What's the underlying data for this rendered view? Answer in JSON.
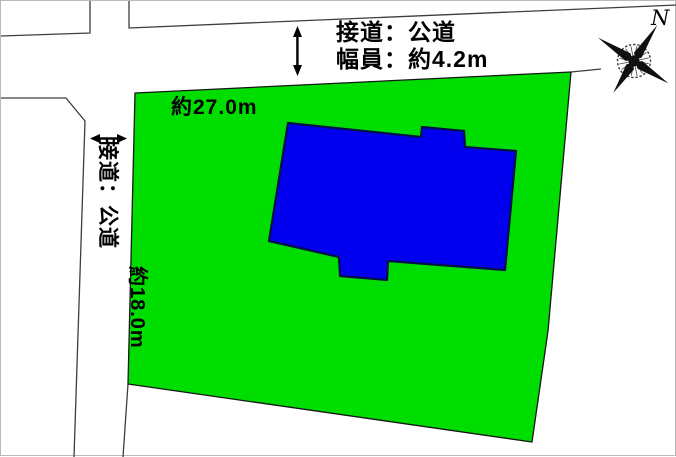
{
  "diagram": {
    "type": "land-plot-layout",
    "annotations": {
      "top_road_access": "接道：公道",
      "top_road_width": "幅員：約4.2m",
      "frontage_top": "約27.0m",
      "left_road_access": "接道：公道",
      "frontage_left": "約18.0m",
      "compass_north": "N"
    },
    "dimensions": {
      "top_frontage_m": 27.0,
      "left_frontage_m": 18.0,
      "top_road_width_m": 4.2
    },
    "colors": {
      "land": "#00dd00",
      "land_outline": "#151515",
      "building": "#0000ee",
      "building_outline": "#001048",
      "road_line": "#3d3d3d",
      "arrow": "#000000",
      "background": "#ffffff"
    }
  }
}
